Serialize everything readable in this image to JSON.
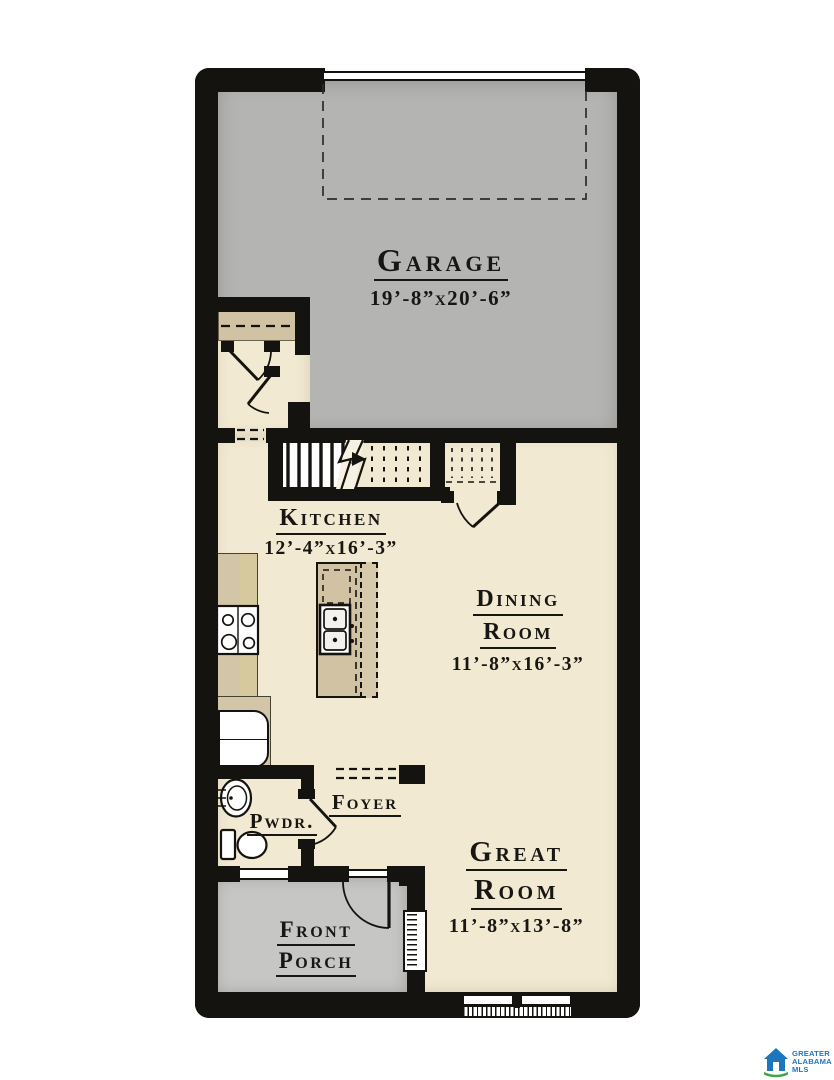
{
  "colors": {
    "wall": "#15130f",
    "text": "#181613",
    "garage_floor": "#b4b4b2",
    "porch_floor": "#c6c6c4",
    "living_floor": "#f1e9d2",
    "cabinet_tan": "#d0c2a2",
    "counter_tan": "#d3c6a8",
    "logo_blue": "#1f75bb",
    "logo_green": "#3aa648"
  },
  "rooms": {
    "garage": {
      "name": "Garage",
      "dims": "19’-8”x20’-6”"
    },
    "kitchen": {
      "name": "Kitchen",
      "dims": "12’-4”x16’-3”"
    },
    "dining_room": {
      "line1": "Dining",
      "line2": "Room",
      "dims": "11’-8”x16’-3”"
    },
    "great_room": {
      "line1": "Great",
      "line2": "Room",
      "dims": "11’-8”x13’-8”"
    },
    "foyer": {
      "name": "Foyer"
    },
    "powder_room": {
      "name": "Pwdr."
    },
    "front_porch": {
      "line1": "Front",
      "line2": "Porch"
    }
  },
  "logo": {
    "line1": "GREATER",
    "line2": "ALABAMA",
    "line3": "MLS"
  }
}
